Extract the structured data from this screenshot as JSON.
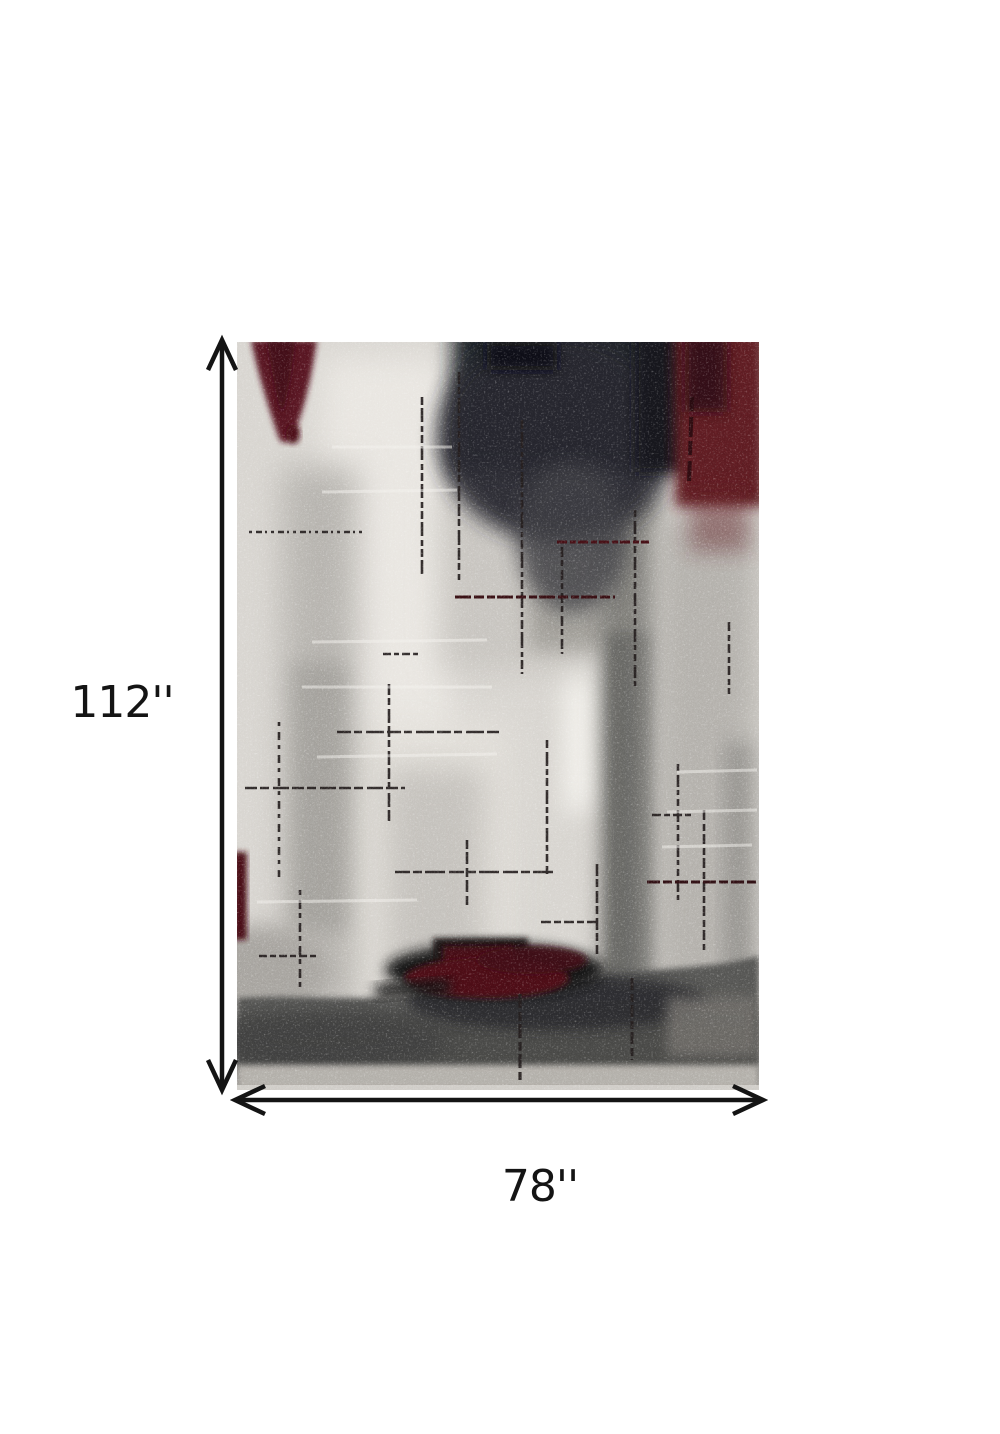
{
  "diagram": {
    "type": "product-dimension-diagram",
    "subject": "abstract distressed area rug in gray, ivory, charcoal and dark red",
    "height": {
      "label": "112''"
    },
    "width": {
      "label": "78''"
    }
  },
  "arrows": {
    "color": "#141414",
    "style": "double-headed open chevron"
  },
  "rug_palette": {
    "base": "#d8d5d0",
    "ivory": "#e9e6e1",
    "charcoal": "#1e2025",
    "maroon": "#5d1b24",
    "dark_red": "#471118",
    "mid_gray": "#7d7b77",
    "bottom_band": "#4b4b4a",
    "bottom_strip": "#b2afa9",
    "scratch_line": "#241e1e"
  },
  "page_background": "#ffffff"
}
